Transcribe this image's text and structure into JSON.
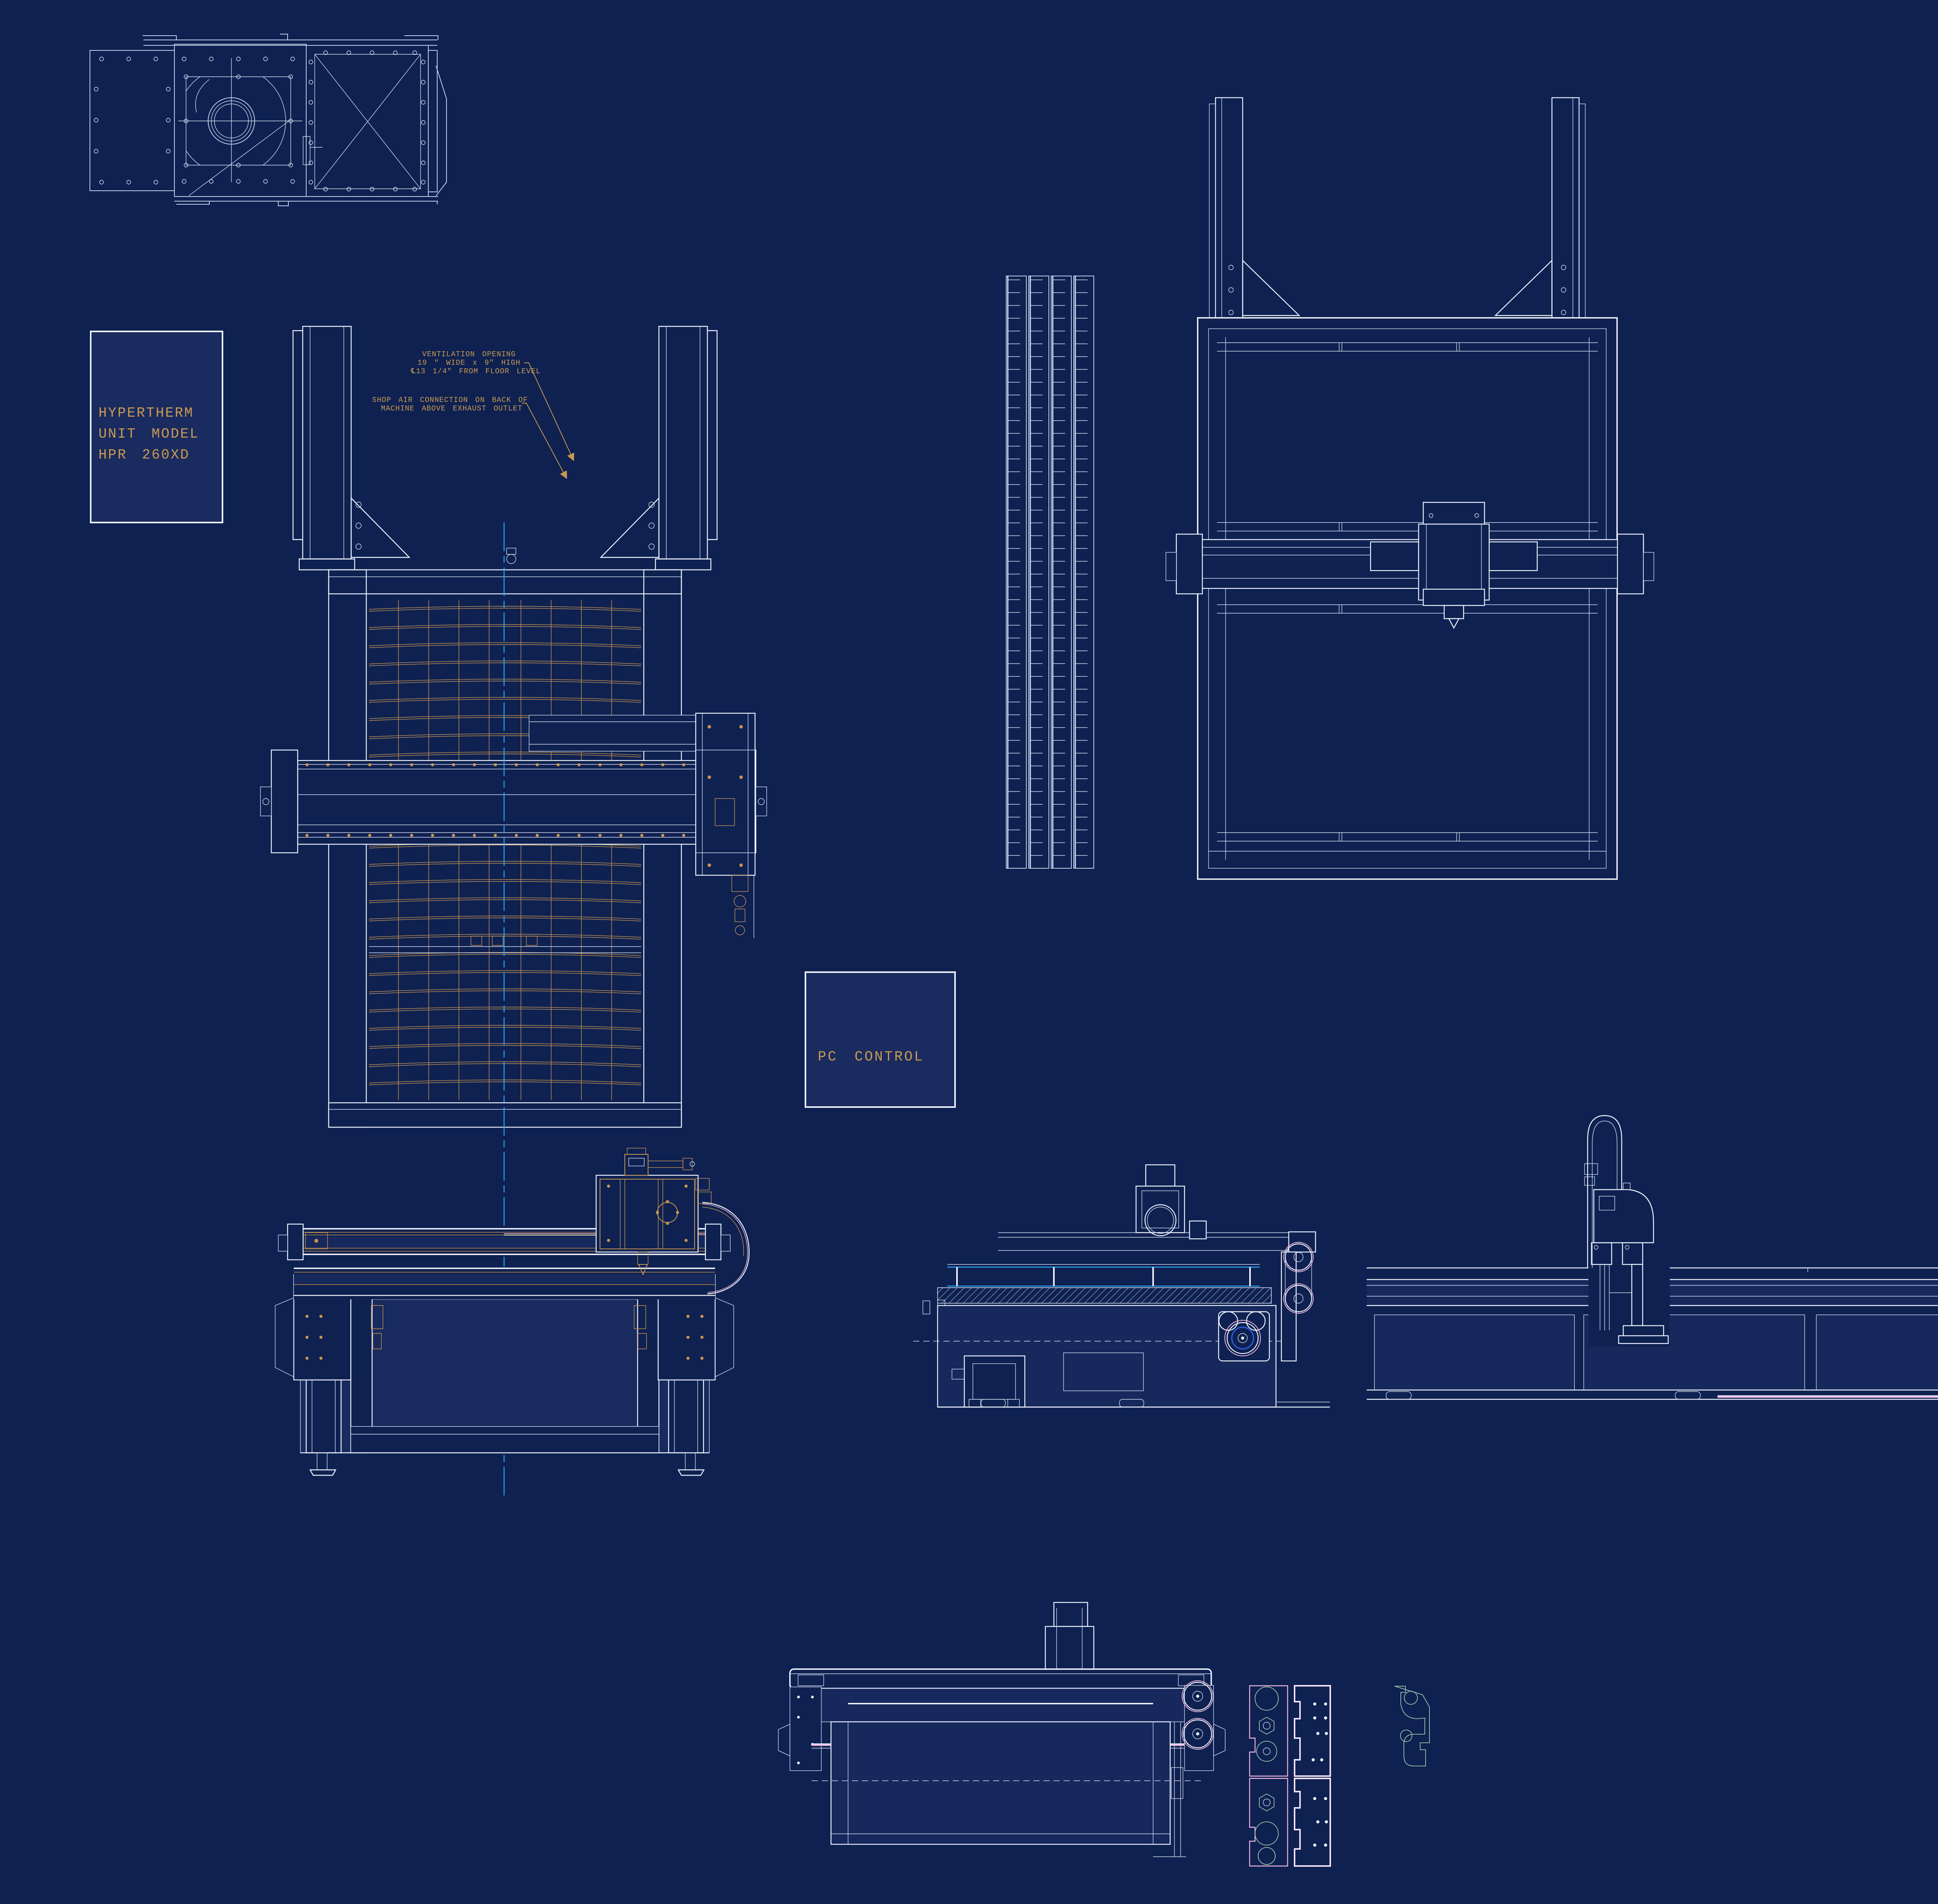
{
  "title": "Plasma cutting machine CAD blueprint",
  "colors": {
    "background": "#0e2151",
    "line_white": "#eef3fc",
    "line_pale": "#c3cfe8",
    "line_tan": "#c9964f",
    "centerline_cyan": "#2da9f5",
    "accent_pink": "#f2b6e0",
    "accent_green": "#9cc7a4",
    "accent_blue_ring": "#2e5fe8"
  },
  "boxes": {
    "hypertherm": {
      "lines": [
        "HYPERTHERM",
        "UNIT MODEL",
        "HPR 260XD"
      ]
    },
    "pc_control": {
      "label": "PC CONTROL"
    }
  },
  "annotations": {
    "ventilation": {
      "lines": [
        "VENTILATION OPENING",
        "19 \" WIDE x 9\" HIGH",
        "℄13 1/4\" FROM FLOOR LEVEL"
      ]
    },
    "shop_air": {
      "lines": [
        "SHOP AIR CONNECTION ON BACK OF",
        "MACHINE ABOVE EXHAUST OUTLET"
      ]
    }
  },
  "views": {
    "exhaust_blower_top": "Exhaust blower / filter unit top view",
    "table_plan_front": "Cutting table plan view with slat bed and gantry",
    "slat_rack": "Slat rack detail",
    "table_plan_rear": "Cutting table plan view (rear)",
    "front_elevation": "Cutting table front elevation with torch carriage",
    "mid_side_elevation": "Drive-side elevation with motor and pulleys",
    "long_side_elevation": "Long side elevation with torch station",
    "gantry_end_elevation": "Gantry end elevation",
    "cut_plate_parts": "CNC-cut bracket plate parts"
  }
}
